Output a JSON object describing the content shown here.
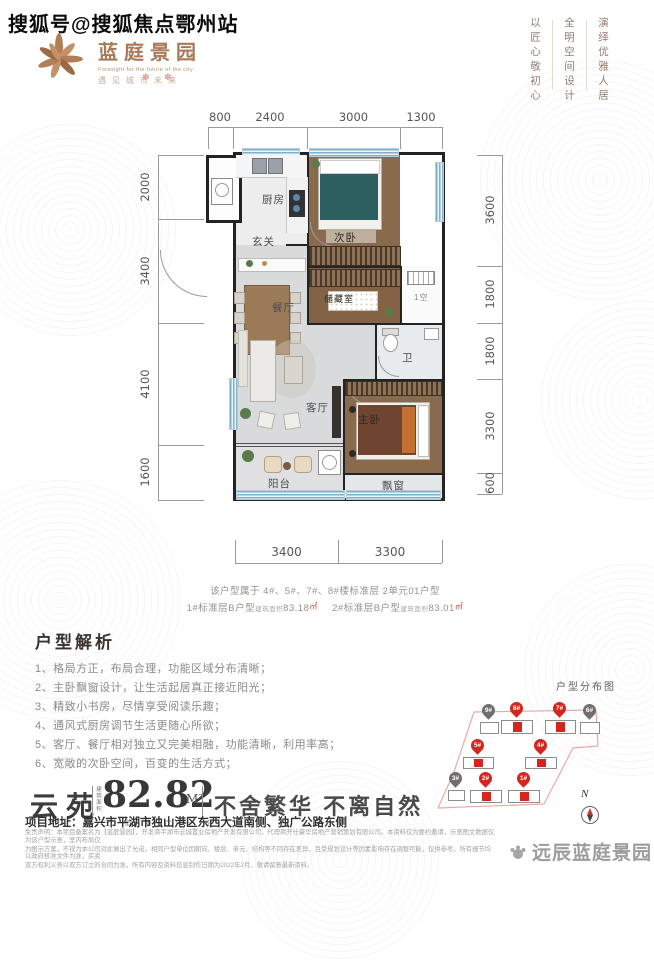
{
  "watermark_top": "搜狐号@搜狐焦点鄂州站",
  "decor_marks": "✽ ✽",
  "logo": {
    "name": "蓝庭景园",
    "tagline_en": "Foresight for the future of the city",
    "tagline_cn": "遇见城市未来"
  },
  "slogans": {
    "col1": "以匠心敬初心",
    "col2": "全明空间设计",
    "col3": "演绎优雅人居"
  },
  "floor_plan": {
    "dims_top": [
      "800",
      "2400",
      "3000",
      "1300"
    ],
    "dims_left": [
      "2000",
      "3400",
      "4100",
      "1600"
    ],
    "dims_right": [
      "3600",
      "1800",
      "1800",
      "3300",
      "600"
    ],
    "dims_bottom": [
      "3400",
      "3300"
    ],
    "rooms": {
      "kitchen": "厨房",
      "foyer": "玄关",
      "bedroom2": "次卧",
      "dining": "餐厅",
      "storage": "储藏室",
      "bath": "卫",
      "living": "客厅",
      "master": "主卧",
      "balcony": "阳台",
      "bay": "飘窗",
      "ac": "1空"
    }
  },
  "captions": {
    "line1": "该户型属于 4#、5#、7#、8#楼标准层 2单元01户型",
    "seg1": "1#标准层B户型",
    "small1": "建筑面积",
    "val1": "83.18",
    "unit1": "㎡",
    "seg2": "2#标准层B户型",
    "small2": "建筑面积",
    "val2": "83.01",
    "unit2": "㎡"
  },
  "analysis": {
    "title": "户型解析",
    "items": [
      "1、格局方正，布局合理，功能区域分布清晰；",
      "2、主卧飘窗设计，让生活起居真正接近阳光；",
      "3、精致小书房，尽情享受阅读乐趣；",
      "4、通风式厨房调节生活更随心所欲；",
      "5、客厅、餐厅相对独立又完美相融，功能清晰，利用率高；",
      "6、宽敞的次卧空间，百变的生活方式；"
    ]
  },
  "sitemap": {
    "title": "户型分布图",
    "compass": "N",
    "pins": [
      {
        "label": "9#",
        "color": "gray"
      },
      {
        "label": "8#",
        "color": "red"
      },
      {
        "label": "7#",
        "color": "red"
      },
      {
        "label": "6#",
        "color": "gray"
      },
      {
        "label": "5#",
        "color": "red"
      },
      {
        "label": "4#",
        "color": "red"
      },
      {
        "label": "3#",
        "color": "gray"
      },
      {
        "label": "2#",
        "color": "red"
      },
      {
        "label": "1#",
        "color": "red"
      }
    ]
  },
  "area_strip": {
    "name": "云苑",
    "area_small": "建筑面积",
    "area": "82.82",
    "unit": "M²",
    "rooms_caption": "三 室 两 厅 一 卫",
    "slogan": "不舍繁华 不离自然"
  },
  "address": "项目地址：嘉兴市平湖市独山港区东西大道南侧、独广公路东侧",
  "legal": [
    "免责声明：本项目备案名为【蓝庭景园】，开发商平湖市云城置业房地产开发有限公司，代理商开仕豪华房地产营销策划有限公司。本资料仅为要约邀请，示意图文数据仅为该户型示意，室内布局仅",
    "为图示方案，不视为本公司对此做出了允诺。相同户型单位因朝向、楼层、单元、结构等不同存在差异，且受规划设计等因素影响存在调整可能，仅供参考。所有细节均以政府核准文件为准，买卖",
    "双方权利义务以双方订立的合同为准。所有内容及资料信息制作日期为2022年2月，敬请留意最新资料。"
  ],
  "footer_watermark": "远辰蓝庭景园",
  "colors": {
    "accent_red": "#d6251f",
    "bronze": "#a87a58"
  }
}
